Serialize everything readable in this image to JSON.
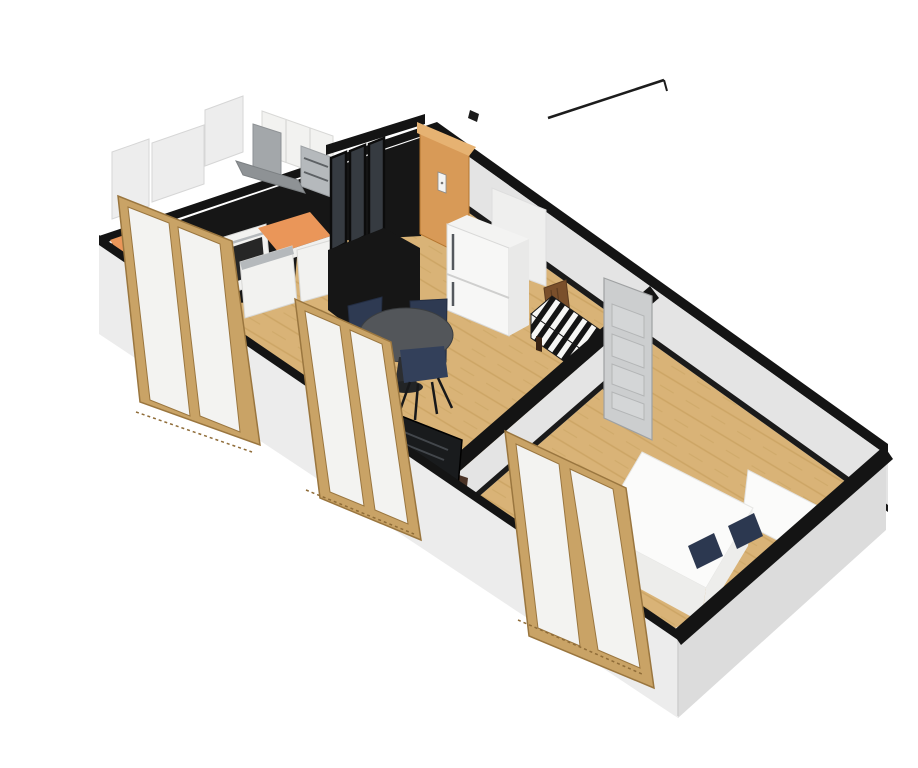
{
  "canvas": {
    "width": 918,
    "height": 768,
    "background": "#ffffff"
  },
  "scene": {
    "type": "3d-floor-plan-render",
    "view": "aerial-cutaway-perspective",
    "rooms": [
      {
        "id": "kitchen",
        "label": "Kitchen",
        "features": [
          "l-shaped-black-counter",
          "orange-cooktop-accents",
          "built-in-oven",
          "dishwasher",
          "upper-cabinets",
          "steel-appliance-tower",
          "range-hood",
          "black-glass-partition"
        ]
      },
      {
        "id": "living-dining",
        "label": "Living / Dining",
        "features": [
          "round-dining-table",
          "navy-chairs",
          "tv-on-wood-stand",
          "striped-daybed",
          "entry-door",
          "fridge"
        ]
      },
      {
        "id": "bedroom",
        "label": "Bedroom",
        "features": [
          "double-bed-white",
          "two-navy-pillows",
          "white-headboard",
          "grey-interior-door"
        ]
      }
    ],
    "openings": {
      "entry_door": "orange wood door, back wall",
      "interior_door": "grey 4-panel door, open, living-bedroom partition",
      "windows": "3 tall wood-framed windows on front facade (kitchen, living, bedroom)"
    },
    "floor": "light oak planks",
    "walls": "white walls cut horizontally, cut plane shown black"
  },
  "colors": {
    "background": "#ffffff",
    "wall_top_cut": "#141414",
    "wall_interior": "#e4e4e4",
    "wall_exterior_sw": "#ececec",
    "wall_exterior_se": "#dcdcdc",
    "baseboard": "#1a1a1a",
    "floor_wood": "#d9b377",
    "floor_plank_line": "#bd954f",
    "counter_black": "#161616",
    "counter_orange": "#ea9659",
    "cabinet_white": "#f2f2f0",
    "appliance_steel": "#b5b9bc",
    "oven_black": "#262626",
    "hood_grey": "#a3a7aa",
    "hood_canopy": "#8e9295",
    "glass_partition": "#363b41",
    "entry_door_wood": "#d89a57",
    "entry_door_light": "#e6b272",
    "interior_door_grey": "#cccecf",
    "door_panel_grey": "#d4d6d7",
    "fridge_white": "#f7f7f6",
    "fridge_side": "#e9e9e8",
    "bench_wood": "#7a4f2b",
    "bench_stripe_dark": "#141414",
    "bench_stripe_light": "#f7f7f5",
    "table_top": "#53565a",
    "chair_navy": "#2e3a52",
    "chair_leg": "#17181a",
    "tv_black": "#191b1d",
    "tv_stand_wood": "#4a3326",
    "bed_white": "#fbfbfa",
    "bed_shadow": "#ededeb",
    "pillow_navy": "#2c3850",
    "window_frame": "#c9a366",
    "window_frame_dark": "#8f6c38",
    "window_pane": "#f3f3f1",
    "panel_white": "#ededed"
  }
}
